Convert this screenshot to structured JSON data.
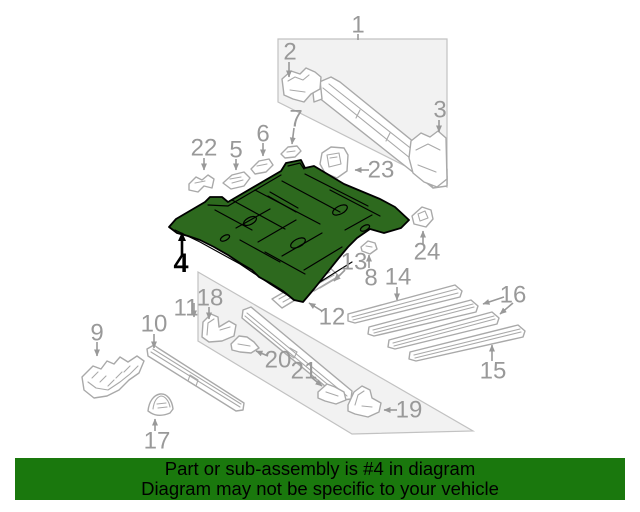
{
  "diagram": {
    "highlighted_part": "4",
    "highlight_color": "#2d691e",
    "label_color": "#999999",
    "art_line_color": "#a9a9a9",
    "callouts": [
      {
        "id": "1",
        "x": 358,
        "y": 25,
        "arrows": [
          {
            "x1": 358,
            "y1": 34,
            "x2": 358,
            "y2": 40,
            "head": false
          }
        ]
      },
      {
        "id": "2",
        "x": 290,
        "y": 52,
        "arrows": [
          {
            "x1": 289,
            "y1": 62,
            "x2": 289,
            "y2": 77
          }
        ]
      },
      {
        "id": "3",
        "x": 440,
        "y": 110,
        "arrows": [
          {
            "x1": 439,
            "y1": 120,
            "x2": 439,
            "y2": 132
          }
        ]
      },
      {
        "id": "4",
        "x": 181,
        "y": 263,
        "highlight": true,
        "arrows": [
          {
            "x1": 182,
            "y1": 257,
            "x2": 182,
            "y2": 233
          }
        ]
      },
      {
        "id": "5",
        "x": 236,
        "y": 150,
        "arrows": [
          {
            "x1": 236,
            "y1": 159,
            "x2": 236,
            "y2": 170
          }
        ]
      },
      {
        "id": "6",
        "x": 263,
        "y": 134,
        "arrows": [
          {
            "x1": 263,
            "y1": 143,
            "x2": 263,
            "y2": 156
          }
        ]
      },
      {
        "id": "7",
        "x": 296,
        "y": 119,
        "arrows": [
          {
            "x1": 294,
            "y1": 128,
            "x2": 292,
            "y2": 144
          }
        ]
      },
      {
        "id": "8",
        "x": 371,
        "y": 278,
        "arrows": [
          {
            "x1": 369,
            "y1": 268,
            "x2": 369,
            "y2": 255
          }
        ]
      },
      {
        "id": "9",
        "x": 97,
        "y": 333,
        "arrows": [
          {
            "x1": 97,
            "y1": 342,
            "x2": 97,
            "y2": 356
          }
        ]
      },
      {
        "id": "10",
        "x": 154,
        "y": 324,
        "arrows": [
          {
            "x1": 154,
            "y1": 334,
            "x2": 154,
            "y2": 348
          }
        ]
      },
      {
        "id": "11",
        "x": 186,
        "y": 308,
        "arrows": [
          {
            "x1": 194,
            "y1": 303,
            "x2": 194,
            "y2": 317
          }
        ]
      },
      {
        "id": "12",
        "x": 332,
        "y": 317,
        "arrows": [
          {
            "x1": 322,
            "y1": 311,
            "x2": 309,
            "y2": 303
          }
        ]
      },
      {
        "id": "13",
        "x": 354,
        "y": 262,
        "arrows": [
          {
            "x1": 345,
            "y1": 270,
            "x2": 334,
            "y2": 281
          }
        ]
      },
      {
        "id": "14",
        "x": 398,
        "y": 277,
        "arrows": [
          {
            "x1": 397,
            "y1": 287,
            "x2": 397,
            "y2": 300
          }
        ]
      },
      {
        "id": "15",
        "x": 493,
        "y": 371,
        "arrows": [
          {
            "x1": 492,
            "y1": 361,
            "x2": 492,
            "y2": 345
          }
        ]
      },
      {
        "id": "16",
        "x": 513,
        "y": 295,
        "arrows": [
          {
            "x1": 504,
            "y1": 297,
            "x2": 483,
            "y2": 304
          },
          {
            "x1": 513,
            "y1": 303,
            "x2": 500,
            "y2": 314
          }
        ]
      },
      {
        "id": "17",
        "x": 157,
        "y": 441,
        "arrows": [
          {
            "x1": 155,
            "y1": 431,
            "x2": 155,
            "y2": 419
          }
        ]
      },
      {
        "id": "18",
        "x": 210,
        "y": 298,
        "arrows": [
          {
            "x1": 209,
            "y1": 307,
            "x2": 209,
            "y2": 319
          }
        ]
      },
      {
        "id": "19",
        "x": 409,
        "y": 410,
        "arrows": [
          {
            "x1": 397,
            "y1": 410,
            "x2": 384,
            "y2": 410
          }
        ]
      },
      {
        "id": "20",
        "x": 278,
        "y": 360,
        "arrows": [
          {
            "x1": 268,
            "y1": 356,
            "x2": 256,
            "y2": 351
          }
        ]
      },
      {
        "id": "21",
        "x": 304,
        "y": 371,
        "arrows": [
          {
            "x1": 311,
            "y1": 377,
            "x2": 322,
            "y2": 386
          }
        ]
      },
      {
        "id": "22",
        "x": 204,
        "y": 148,
        "arrows": [
          {
            "x1": 204,
            "y1": 158,
            "x2": 204,
            "y2": 170
          }
        ]
      },
      {
        "id": "23",
        "x": 381,
        "y": 170,
        "arrows": [
          {
            "x1": 369,
            "y1": 170,
            "x2": 355,
            "y2": 170
          }
        ]
      },
      {
        "id": "24",
        "x": 427,
        "y": 252,
        "arrows": [
          {
            "x1": 423,
            "y1": 244,
            "x2": 423,
            "y2": 231
          }
        ]
      }
    ]
  },
  "banner": {
    "bg_color": "#1a780d",
    "text_color": "#000000",
    "line1": "Part or sub-assembly is #4 in diagram",
    "line2": "Diagram may not be specific to your vehicle"
  }
}
